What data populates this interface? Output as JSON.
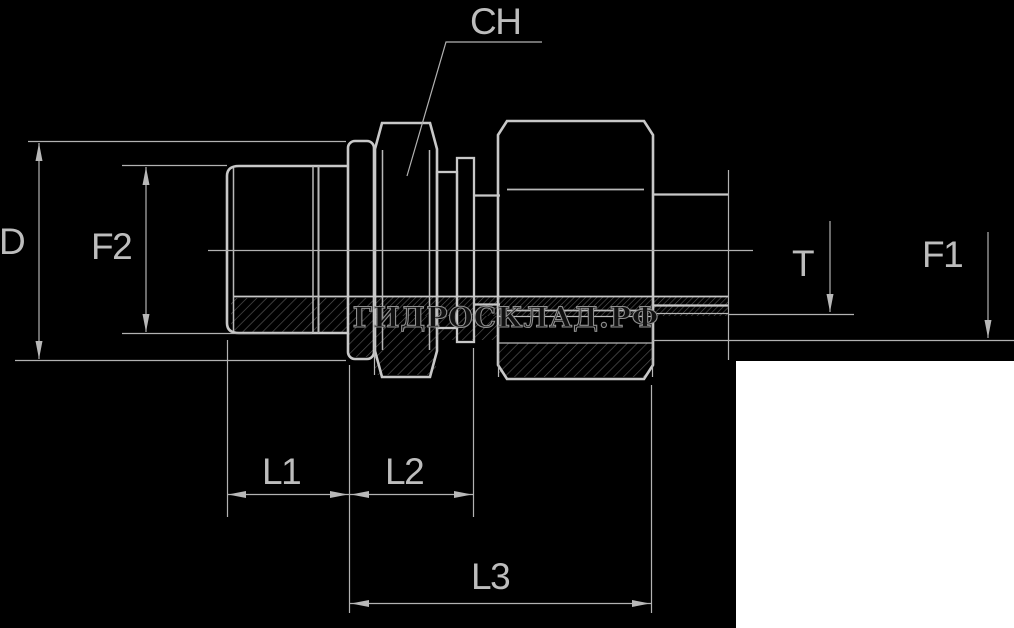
{
  "diagram": {
    "labels": {
      "ch": "CH",
      "d": "D",
      "f2": "F2",
      "t": "T",
      "f1": "F1",
      "l1": "L1",
      "l2": "L2",
      "l3": "L3"
    },
    "watermark": "ГИДРОСКЛАД.РФ",
    "colors": {
      "background": "#000000",
      "line_main": "#c8c8c8",
      "line_thin": "#b2b2b2",
      "hatch": "#565656",
      "label_text": "#bdbdbd",
      "watermark_outline": "#8f8f8f",
      "corner_panel": "#ffffff"
    }
  }
}
